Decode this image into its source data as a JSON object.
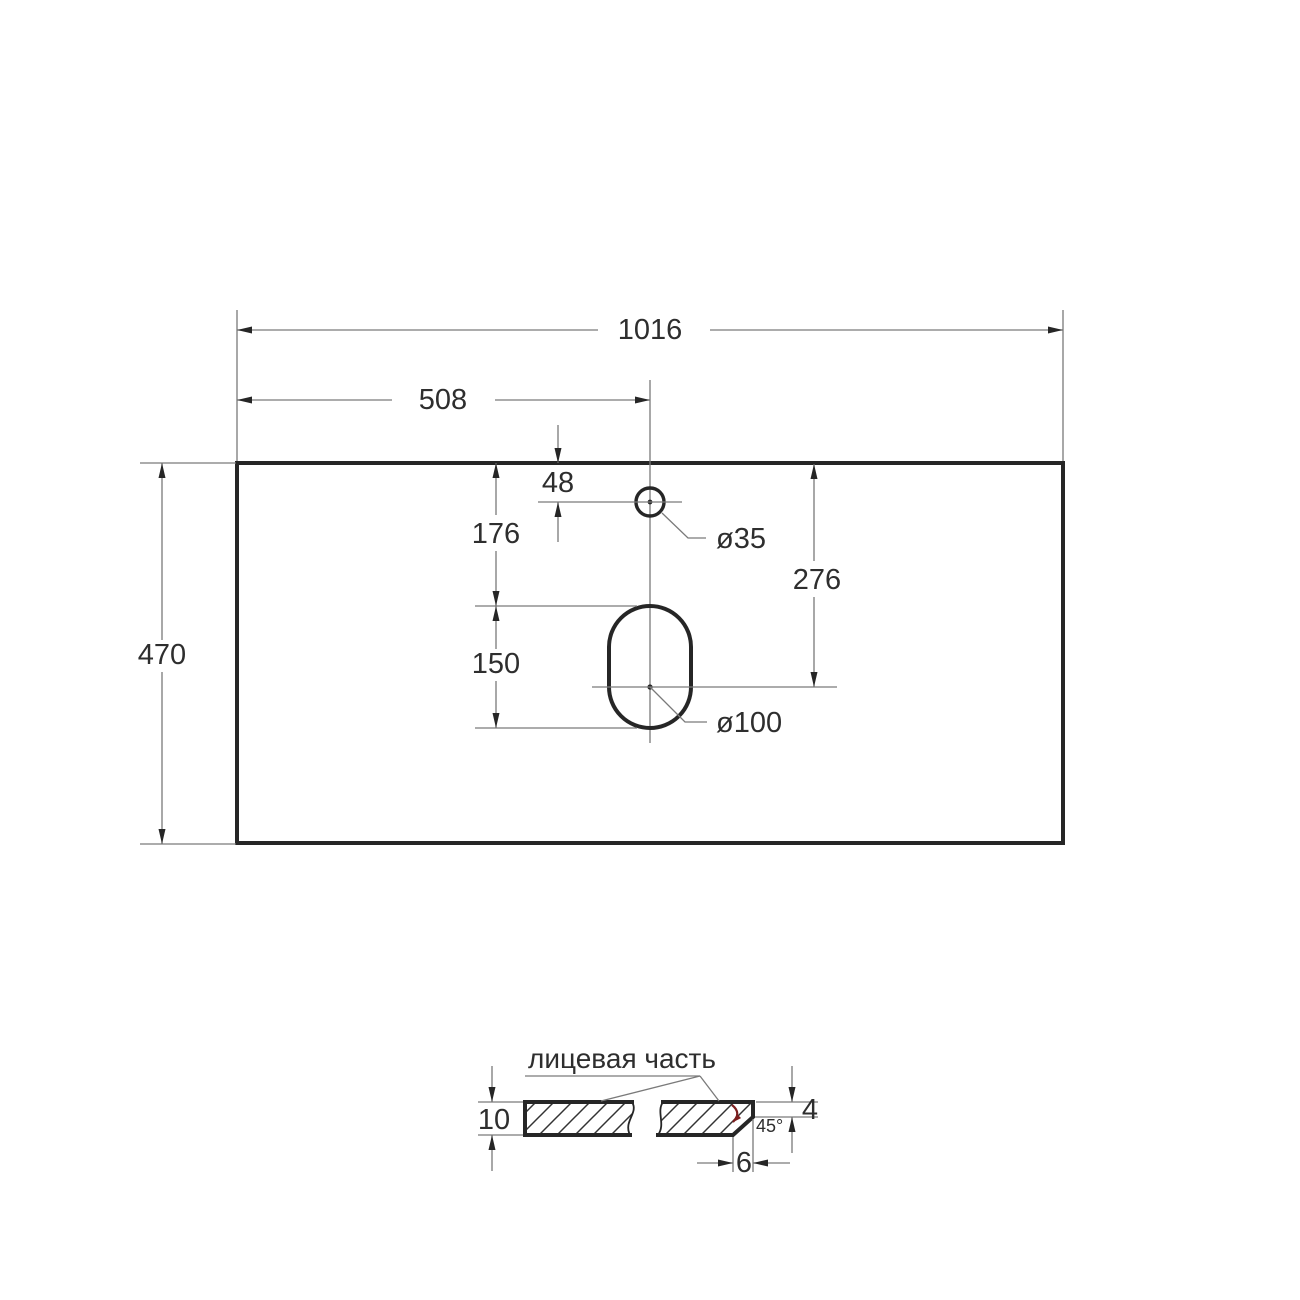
{
  "drawing": {
    "background": "#ffffff",
    "colors": {
      "outline": "#262626",
      "dimension_lines": "#7a7a7a",
      "text": "#2e2e2e",
      "angle_arrow": "#7b1e1e"
    },
    "plan_view": {
      "width_label": "1016",
      "center_offset_label": "508",
      "depth_label": "470",
      "faucet_offset_label": "48",
      "drain_top_offset_label": "176",
      "drain_center_offset_label": "276",
      "drain_length_label": "150",
      "faucet_diameter_label": "ø35",
      "drain_diameter_label": "ø100"
    },
    "section_view": {
      "face_label": "лицевая часть",
      "thickness_label": "10",
      "edge_thickness_label": "4",
      "chamfer_angle_label": "45°",
      "chamfer_depth_label": "6"
    }
  }
}
